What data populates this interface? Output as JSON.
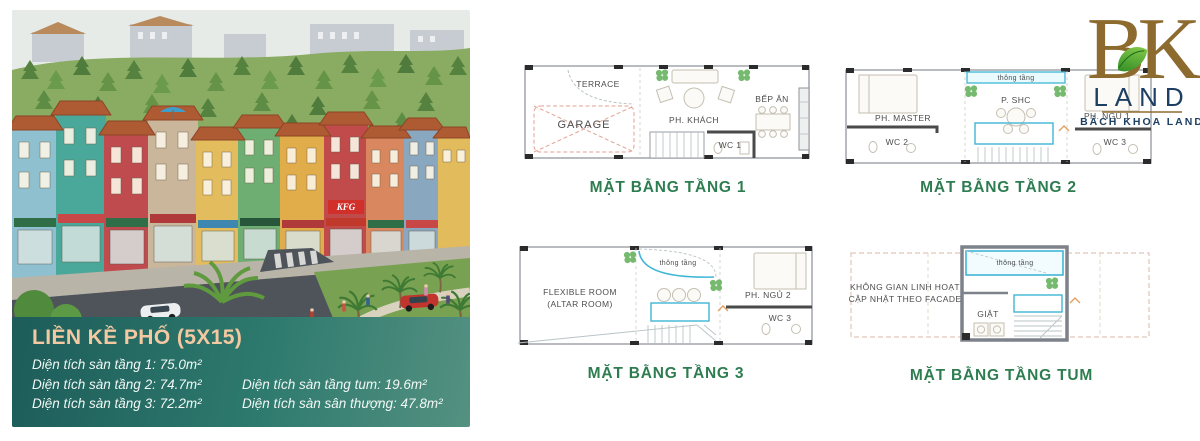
{
  "brand": {
    "monogram": "BK",
    "name": "LAND",
    "tagline": "BÁCH KHOA LAND"
  },
  "hero": {
    "kfc_sign": "KFG"
  },
  "overlay": {
    "title": "LIỀN KỀ PHỐ (5X15)",
    "specs_left": [
      "Diện tích sàn tầng 1: 75.0m²",
      "Diện tích sàn tầng 2: 74.7m²",
      "Diện tích sàn tầng 3: 72.2m²"
    ],
    "specs_right": [
      "Diện tích sàn tầng tum: 19.6m²",
      "Diện tích sàn sân thượng: 47.8m²"
    ]
  },
  "plans": {
    "floor1": {
      "caption": "MẶT BẰNG TẦNG 1",
      "rooms": {
        "terrace": "TERRACE",
        "garage": "GARAGE",
        "living": "PH. KHÁCH",
        "kitchen": "BẾP ĂN",
        "wc": "WC 1"
      }
    },
    "floor2": {
      "caption": "MẶT BẰNG TẦNG 2",
      "rooms": {
        "master": "PH. MASTER",
        "wc2": "WC 2",
        "void": "thông tầng",
        "shc": "P. SHC",
        "bed1": "PH. NGỦ 1",
        "wc3": "WC 3"
      }
    },
    "floor3": {
      "caption": "MẶT BẰNG TẦNG 3",
      "rooms": {
        "flex1": "FLEXIBLE ROOM",
        "flex2": "(ALTAR ROOM)",
        "void": "thông tầng",
        "bed2": "PH. NGỦ 2",
        "wc3": "WC 3"
      }
    },
    "tum": {
      "caption": "MẶT BẰNG TẦNG TUM",
      "rooms": {
        "void": "thông tầng",
        "note1": "KHÔNG GIAN LINH HOẠT",
        "note2": "CẬP NHẬT THEO FACADE",
        "laundry": "GIẶT"
      }
    }
  },
  "colors": {
    "caption_green": "#2e7d51",
    "panel_teal_dark": "#1d5c59",
    "panel_teal_light": "#549181",
    "title_peach": "#f4c9a2",
    "logo_gold": "#8d6b2f",
    "logo_navy": "#1c3f63",
    "plan_cyan": "#3fb6d6",
    "leaf_green": "#57a33b",
    "roof_terracotta": "#ae5a33"
  }
}
